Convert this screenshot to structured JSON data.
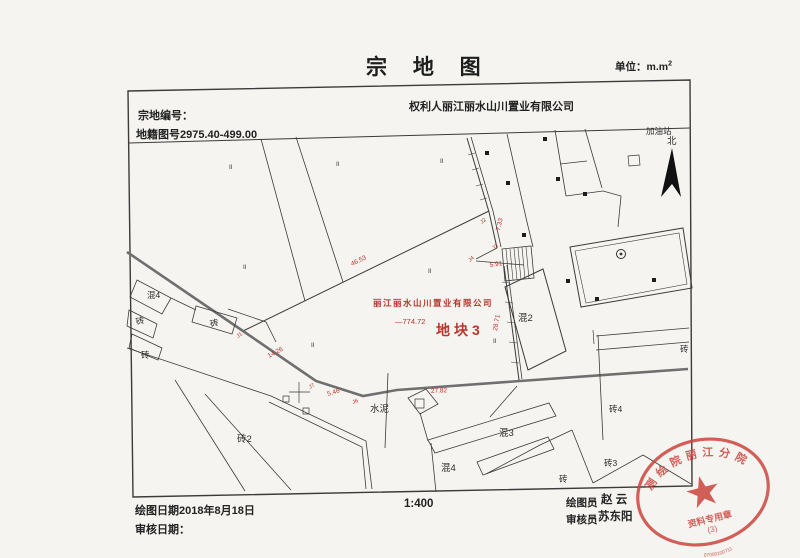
{
  "page": {
    "title": "宗 地 图",
    "unit": "单位：m.m",
    "unit_sup": "2"
  },
  "header": {
    "parcel_no_label": "宗地编号：",
    "cadastral_no": "地籍图号2975.40-499.00",
    "owner_line": "权利人丽江丽水山川置业有限公司"
  },
  "footer": {
    "draw_date": "绘图日期2018年8月18日",
    "review_date": "审核日期：",
    "scale": "1:400",
    "drafter_label": "绘图员",
    "drafter_name": "赵 云",
    "reviewer_label": "审核员",
    "reviewer_name": "苏东阳"
  },
  "map": {
    "red_color": "#b7352b",
    "line_color": "#3b3b3b",
    "north_arrow": [
      [
        672,
        148
      ],
      [
        661,
        197
      ],
      [
        672,
        184
      ],
      [
        681,
        197
      ]
    ],
    "circle_symbol": {
      "x": 621,
      "y": 254,
      "r": 4.5
    },
    "dots": [
      [
        487,
        153
      ],
      [
        508,
        183
      ],
      [
        524,
        235
      ],
      [
        545,
        139
      ],
      [
        558,
        179
      ],
      [
        568,
        281
      ],
      [
        585,
        194
      ],
      [
        597,
        299
      ],
      [
        654,
        280
      ]
    ],
    "roman_marker_text": "II",
    "roman_markers": [
      [
        229,
        169
      ],
      [
        336,
        166
      ],
      [
        440,
        163
      ],
      [
        243,
        269
      ],
      [
        428,
        273
      ],
      [
        493,
        343
      ],
      [
        311,
        347
      ]
    ],
    "black_labels": [
      {
        "t": "加油站",
        "x": 646,
        "y": 134,
        "s": 8.5
      },
      {
        "t": "北",
        "x": 667,
        "y": 144,
        "s": 9.5
      },
      {
        "t": "混4",
        "x": 147,
        "y": 298,
        "s": 8.5
      },
      {
        "t": "砖",
        "x": 137,
        "y": 325,
        "s": 8.5,
        "r": -18
      },
      {
        "t": "砖",
        "x": 211,
        "y": 327,
        "s": 8.5,
        "r": -15
      },
      {
        "t": "砖",
        "x": 141,
        "y": 358,
        "s": 8.5
      },
      {
        "t": "砖2",
        "x": 237,
        "y": 442,
        "s": 9.5
      },
      {
        "t": "水泥",
        "x": 370,
        "y": 412,
        "s": 9.5
      },
      {
        "t": "混2",
        "x": 518,
        "y": 321,
        "s": 9.5
      },
      {
        "t": "混3",
        "x": 499,
        "y": 436,
        "s": 9.5
      },
      {
        "t": "混4",
        "x": 441,
        "y": 471,
        "s": 9.5
      },
      {
        "t": "砖",
        "x": 559,
        "y": 482,
        "s": 8.5
      },
      {
        "t": "砖4",
        "x": 609,
        "y": 412,
        "s": 8.5
      },
      {
        "t": "砖",
        "x": 680,
        "y": 352,
        "s": 8.5
      },
      {
        "t": "砖3",
        "x": 604,
        "y": 466,
        "s": 8.5
      }
    ],
    "red_labels": [
      {
        "t": "46.53",
        "x": 352,
        "y": 266,
        "s": 6.5,
        "r": -26
      },
      {
        "t": "7.33",
        "x": 500,
        "y": 231,
        "s": 6.5,
        "r": -78
      },
      {
        "t": "J2",
        "x": 482,
        "y": 224,
        "s": 5.5,
        "r": -40
      },
      {
        "t": "J3",
        "x": 494,
        "y": 250,
        "s": 5.5,
        "r": -40
      },
      {
        "t": "J4",
        "x": 470,
        "y": 262,
        "s": 5.5,
        "r": -40
      },
      {
        "t": "5.91",
        "x": 490,
        "y": 267,
        "s": 6.5,
        "r": -8
      },
      {
        "t": "28.71",
        "x": 497,
        "y": 331,
        "s": 6.5,
        "r": -80
      },
      {
        "t": "J1",
        "x": 238,
        "y": 338,
        "s": 5.5,
        "r": -35
      },
      {
        "t": "14.26",
        "x": 269,
        "y": 358,
        "s": 6.5,
        "r": -28
      },
      {
        "t": "J7",
        "x": 310,
        "y": 389,
        "s": 5.5,
        "r": -30
      },
      {
        "t": "5.46",
        "x": 328,
        "y": 396,
        "s": 6.5,
        "r": -18
      },
      {
        "t": "J6",
        "x": 353,
        "y": 404,
        "s": 5.5,
        "r": -20
      },
      {
        "t": "27.82",
        "x": 431,
        "y": 393,
        "s": 6.5,
        "r": -3
      },
      {
        "t": "丽江丽水山川置业有限公司",
        "x": 373,
        "y": 306,
        "s": 8.5,
        "b": 1,
        "ls": 1.5
      },
      {
        "t": "—774.72",
        "x": 395,
        "y": 324,
        "s": 7.5
      },
      {
        "t": "地块3",
        "x": 436,
        "y": 335,
        "s": 14,
        "b": 1,
        "ls": 4
      }
    ],
    "paths": [
      {
        "p": [
          [
            128,
            91
          ],
          [
            690,
            80
          ],
          [
            692,
            486
          ],
          [
            133,
            497
          ]
        ],
        "close": true,
        "w": 1.4
      },
      {
        "p": [
          [
            129,
            143
          ],
          [
            690,
            128
          ]
        ],
        "w": 1
      },
      {
        "p": [
          [
            261,
            139
          ],
          [
            305,
            301
          ]
        ]
      },
      {
        "p": [
          [
            296,
            137
          ],
          [
            343,
            282
          ]
        ]
      },
      {
        "p": [
          [
            243,
            331
          ],
          [
            489,
            211
          ]
        ],
        "w": 1
      },
      {
        "p": [
          [
            127,
            252
          ],
          [
            243,
            331
          ],
          [
            316,
            381
          ],
          [
            363,
            396
          ],
          [
            397,
            390
          ],
          [
            520,
            381
          ],
          [
            688,
            369
          ]
        ],
        "w": 2.6,
        "c": "#6f6f6f"
      },
      {
        "p": [
          [
            467,
            138
          ],
          [
            489,
            212
          ]
        ],
        "w": 1
      },
      {
        "p": [
          [
            471,
            137
          ],
          [
            493,
            211
          ]
        ]
      },
      {
        "p": [
          [
            507,
            134
          ],
          [
            527,
            222
          ],
          [
            533,
            247
          ]
        ]
      },
      {
        "p": [
          [
            489,
            212
          ],
          [
            497,
            248
          ]
        ],
        "w": 1
      },
      {
        "p": [
          [
            493,
            211
          ],
          [
            501,
            247
          ]
        ]
      },
      {
        "p": [
          [
            497,
            248
          ],
          [
            476,
            259
          ]
        ]
      },
      {
        "p": [
          [
            476,
            261
          ],
          [
            524,
            265
          ]
        ]
      },
      {
        "p": [
          [
            504,
            266
          ],
          [
            519,
            380
          ]
        ],
        "w": 1
      },
      {
        "p": [
          [
            507,
            265
          ],
          [
            522,
            379
          ]
        ]
      },
      {
        "p": [
          [
            502,
            249
          ],
          [
            531,
            246
          ],
          [
            534,
            278
          ],
          [
            505,
            281
          ]
        ],
        "close": true
      },
      {
        "p": [
          [
            506,
            249
          ],
          [
            509,
            281
          ]
        ],
        "w": 0.6
      },
      {
        "p": [
          [
            510,
            249
          ],
          [
            513,
            280
          ]
        ],
        "w": 0.6
      },
      {
        "p": [
          [
            514,
            248
          ],
          [
            517,
            280
          ]
        ],
        "w": 0.6
      },
      {
        "p": [
          [
            518,
            248
          ],
          [
            521,
            280
          ]
        ],
        "w": 0.6
      },
      {
        "p": [
          [
            522,
            247
          ],
          [
            525,
            279
          ]
        ],
        "w": 0.6
      },
      {
        "p": [
          [
            526,
            247
          ],
          [
            529,
            279
          ]
        ],
        "w": 0.6
      },
      {
        "p": [
          [
            505,
            287
          ],
          [
            543,
            269
          ],
          [
            566,
            351
          ],
          [
            528,
            370
          ]
        ],
        "close": true,
        "w": 1
      },
      {
        "p": [
          [
            570,
            247
          ],
          [
            683,
            228
          ],
          [
            692,
            288
          ],
          [
            581,
            307
          ]
        ],
        "close": true,
        "w": 1
      },
      {
        "p": [
          [
            575,
            251
          ],
          [
            679,
            233
          ],
          [
            687,
            284
          ],
          [
            586,
            303
          ]
        ],
        "close": true,
        "w": 0.6
      },
      {
        "p": [
          [
            137,
            280
          ],
          [
            171,
            298
          ],
          [
            162,
            314
          ],
          [
            130,
            297
          ]
        ],
        "close": true
      },
      {
        "p": [
          [
            129,
            310
          ],
          [
            157,
            324
          ],
          [
            153,
            338
          ],
          [
            127,
            326
          ]
        ],
        "close": true
      },
      {
        "p": [
          [
            132,
            334
          ],
          [
            162,
            348
          ],
          [
            158,
            360
          ],
          [
            129,
            348
          ]
        ],
        "close": true
      },
      {
        "p": [
          [
            171,
            298
          ],
          [
            196,
            310
          ]
        ]
      },
      {
        "p": [
          [
            196,
            306
          ],
          [
            237,
            318
          ],
          [
            232,
            334
          ],
          [
            192,
            322
          ]
        ],
        "close": true
      },
      {
        "p": [
          [
            228,
            309
          ],
          [
            266,
            322
          ],
          [
            276,
            342
          ]
        ]
      },
      {
        "p": [
          [
            127,
            348
          ],
          [
            271,
            396
          ]
        ]
      },
      {
        "p": [
          [
            271,
            396
          ],
          [
            366,
            441
          ],
          [
            372,
            489
          ]
        ]
      },
      {
        "p": [
          [
            269,
            402
          ],
          [
            362,
            447
          ],
          [
            366,
            489
          ]
        ]
      },
      {
        "p": [
          [
            175,
            380
          ],
          [
            245,
            491
          ]
        ]
      },
      {
        "p": [
          [
            205,
            394
          ],
          [
            291,
            490
          ]
        ]
      },
      {
        "p": [
          [
            299,
            382
          ],
          [
            299,
            403
          ]
        ],
        "w": 0.7
      },
      {
        "p": [
          [
            289,
            392
          ],
          [
            310,
            392
          ]
        ],
        "w": 0.7
      },
      {
        "p": [
          [
            283,
            396
          ],
          [
            289,
            396
          ],
          [
            289,
            402
          ],
          [
            283,
            402
          ]
        ],
        "close": true,
        "w": 0.7
      },
      {
        "p": [
          [
            303,
            408
          ],
          [
            309,
            408
          ],
          [
            309,
            414
          ],
          [
            303,
            414
          ]
        ],
        "close": true,
        "w": 0.7
      },
      {
        "p": [
          [
            408,
            398
          ],
          [
            426,
            389
          ],
          [
            438,
            404
          ],
          [
            420,
            414
          ]
        ],
        "close": true
      },
      {
        "p": [
          [
            415,
            399
          ],
          [
            424,
            399
          ],
          [
            424,
            408
          ],
          [
            415,
            408
          ]
        ],
        "close": true,
        "w": 0.7
      },
      {
        "p": [
          [
            388,
            373
          ],
          [
            385,
            448
          ]
        ]
      },
      {
        "p": [
          [
            490,
            417
          ],
          [
            517,
            386
          ]
        ]
      },
      {
        "p": [
          [
            420,
            413
          ],
          [
            428,
            441
          ]
        ]
      },
      {
        "p": [
          [
            428,
            440
          ],
          [
            549,
            403
          ],
          [
            556,
            416
          ],
          [
            435,
            453
          ]
        ],
        "close": true
      },
      {
        "p": [
          [
            477,
            462
          ],
          [
            548,
            437
          ],
          [
            554,
            449
          ],
          [
            483,
            475
          ]
        ],
        "close": true
      },
      {
        "p": [
          [
            431,
            443
          ],
          [
            436,
            492
          ]
        ]
      },
      {
        "p": [
          [
            486,
            474
          ],
          [
            540,
            445
          ],
          [
            572,
            430
          ]
        ]
      },
      {
        "p": [
          [
            572,
            430
          ],
          [
            593,
            483
          ]
        ]
      },
      {
        "p": [
          [
            593,
            483
          ],
          [
            643,
            455
          ]
        ]
      },
      {
        "p": [
          [
            643,
            455
          ],
          [
            691,
            484
          ]
        ]
      },
      {
        "p": [
          [
            555,
            130
          ],
          [
            566,
            196
          ]
        ]
      },
      {
        "p": [
          [
            585,
            129
          ],
          [
            602,
            188
          ]
        ]
      },
      {
        "p": [
          [
            560,
            164
          ],
          [
            587,
            161
          ]
        ]
      },
      {
        "p": [
          [
            566,
            196
          ],
          [
            603,
            191
          ]
        ]
      },
      {
        "p": [
          [
            603,
            191
          ],
          [
            621,
            196
          ],
          [
            618,
            227
          ]
        ]
      },
      {
        "p": [
          [
            628,
            156
          ],
          [
            639,
            155
          ],
          [
            640,
            165
          ],
          [
            629,
            166
          ]
        ],
        "close": true,
        "w": 0.7
      },
      {
        "p": [
          [
            596,
            336
          ],
          [
            689,
            328
          ]
        ]
      },
      {
        "p": [
          [
            596,
            350
          ],
          [
            689,
            342
          ]
        ]
      },
      {
        "p": [
          [
            593,
            330
          ],
          [
            594,
            344
          ]
        ],
        "w": 0.7
      },
      {
        "p": [
          [
            598,
            335
          ],
          [
            603,
            440
          ]
        ]
      },
      {
        "p": [
          [
            502,
            282
          ],
          [
            510,
            283
          ]
        ],
        "w": 0.6
      },
      {
        "p": [
          [
            505,
            302
          ],
          [
            513,
            303
          ]
        ],
        "w": 0.6
      },
      {
        "p": [
          [
            507,
            322
          ],
          [
            515,
            323
          ]
        ],
        "w": 0.6
      },
      {
        "p": [
          [
            509,
            342
          ],
          [
            517,
            343
          ]
        ],
        "w": 0.6
      },
      {
        "p": [
          [
            511,
            362
          ],
          [
            519,
            363
          ]
        ],
        "w": 0.6
      },
      {
        "p": [
          [
            468,
            155
          ],
          [
            475,
            153
          ]
        ],
        "w": 0.6
      },
      {
        "p": [
          [
            472,
            170
          ],
          [
            479,
            168
          ]
        ],
        "w": 0.6
      },
      {
        "p": [
          [
            476,
            186
          ],
          [
            483,
            184
          ]
        ],
        "w": 0.6
      },
      {
        "p": [
          [
            480,
            200
          ],
          [
            487,
            198
          ]
        ],
        "w": 0.6
      }
    ]
  },
  "seal": {
    "color": "#cb463e",
    "arc_top": "测绘院丽江分院",
    "star": "★",
    "line1": "资料专用章",
    "line2": "(3)",
    "arc_bottom": "07000100711"
  }
}
